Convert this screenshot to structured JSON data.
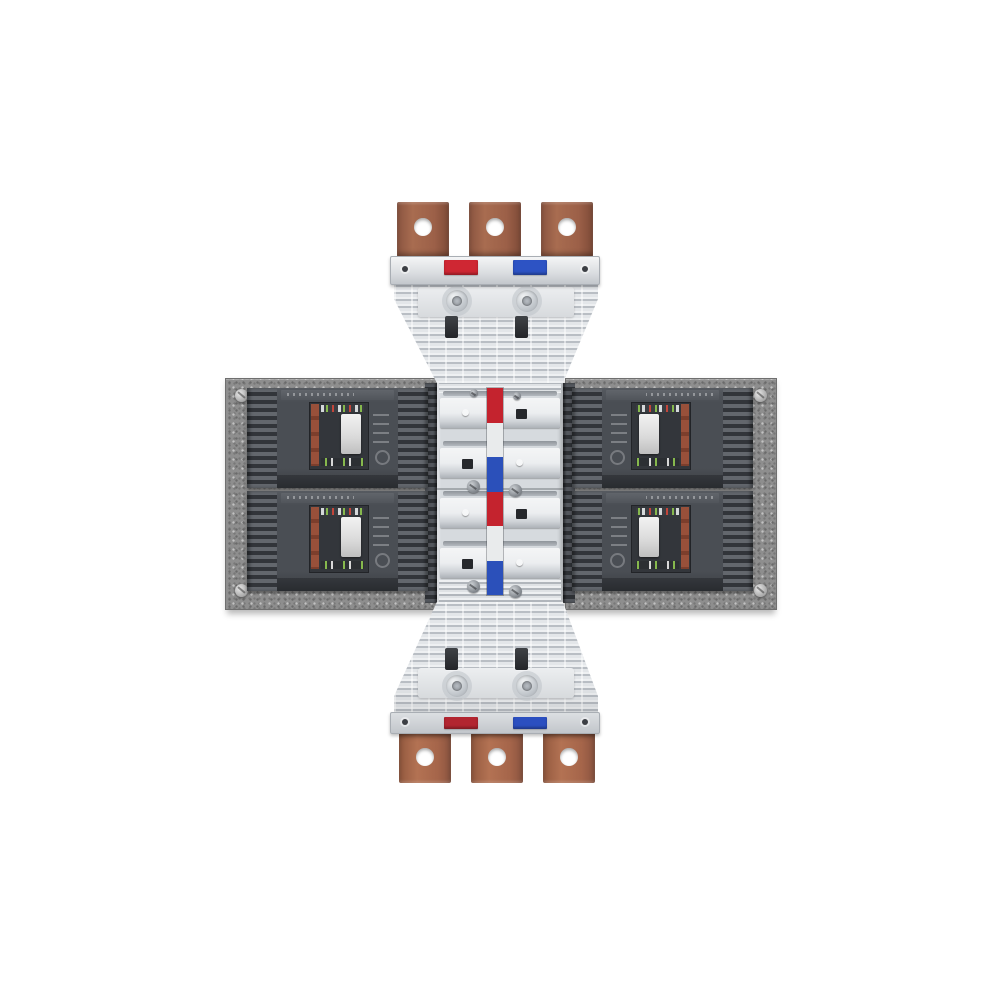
{
  "scene": {
    "type": "product-photo",
    "subject": "Three-phase busbar adapter assembly with four molded-case circuit breakers mounted on speckled metal plates",
    "background_color": "#ffffff"
  },
  "palette": {
    "copper": "#9c6048",
    "copper_light": "#b07257",
    "copper_dark": "#7e4b38",
    "marker_red": "#cf2733",
    "marker_blue": "#2d53c4",
    "marker_red_bottom": "#b22530",
    "marker_blue_bottom": "#2b4fc0",
    "stripe_red": "#c4232e",
    "stripe_white": "#e9ebec",
    "stripe_blue": "#2b50ba",
    "adapter_body": "#dde0e3",
    "column_body": "#d6dade",
    "plate_gray": "#8e8e8e",
    "breaker_gray": "#4a4e54",
    "breaker_label_red": "#8f4a38",
    "toggle_white": "#e6e6e6",
    "slot_black": "#26282c"
  },
  "top_assembly": {
    "terminals": [
      "terminal-1",
      "terminal-2",
      "terminal-3"
    ],
    "phase_markers": [
      {
        "name": "red",
        "color_key": "marker_red"
      },
      {
        "name": "blue",
        "color_key": "marker_blue"
      }
    ]
  },
  "bottom_assembly": {
    "terminals": [
      "terminal-1",
      "terminal-2",
      "terminal-3"
    ],
    "phase_markers": [
      {
        "name": "red",
        "color_key": "marker_red_bottom"
      },
      {
        "name": "blue",
        "color_key": "marker_blue_bottom"
      }
    ]
  },
  "center_column": {
    "stripe_segments": [
      "red",
      "white",
      "blue",
      "red",
      "white",
      "blue"
    ],
    "flaps": [
      {
        "left": "dot",
        "right": "square"
      },
      {
        "left": "square",
        "right": "dot"
      },
      {
        "left": "dot",
        "right": "square"
      },
      {
        "left": "square",
        "right": "dot"
      }
    ]
  },
  "breakers": [
    {
      "side": "left",
      "row": "top"
    },
    {
      "side": "left",
      "row": "bottom"
    },
    {
      "side": "right",
      "row": "top"
    },
    {
      "side": "right",
      "row": "bottom"
    }
  ],
  "plates": [
    {
      "side": "left",
      "screw_count": 2
    },
    {
      "side": "right",
      "screw_count": 2
    }
  ]
}
